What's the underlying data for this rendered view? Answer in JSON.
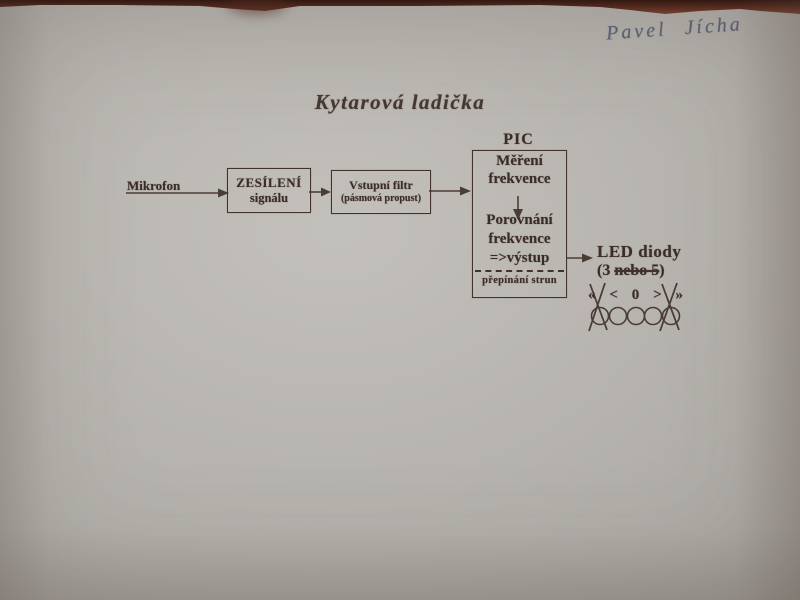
{
  "photo": {
    "handwritten_name": "Pavel Jícha",
    "title": "Kytarová ladička"
  },
  "diagram": {
    "mikrofon_label": "Mikrofon",
    "amp_box": {
      "line1": "ZESÍLENÍ",
      "line2": "signálu"
    },
    "filter_box": {
      "line1": "Vstupní filtr",
      "line2": "(pásmová propust)"
    },
    "pic_box": {
      "label": "PIC",
      "measure_line1": "Měření",
      "measure_line2": "frekvence",
      "compare_line1": "Porovnání",
      "compare_line2": "frekvence",
      "compare_line3": "=>výstup",
      "bottom_label": "přepínání strun"
    },
    "led": {
      "label": "LED diody",
      "count_prefix": "(3 ",
      "count_struck": "nebo 5",
      "count_suffix": ")",
      "symbols": [
        "«",
        "<",
        "0",
        ">",
        "»"
      ]
    }
  },
  "colors": {
    "paper": "#b2afaa",
    "ink": "#3b2c27",
    "handwriting_ink": "#5c6378",
    "table_background": "#5a2b1e"
  }
}
